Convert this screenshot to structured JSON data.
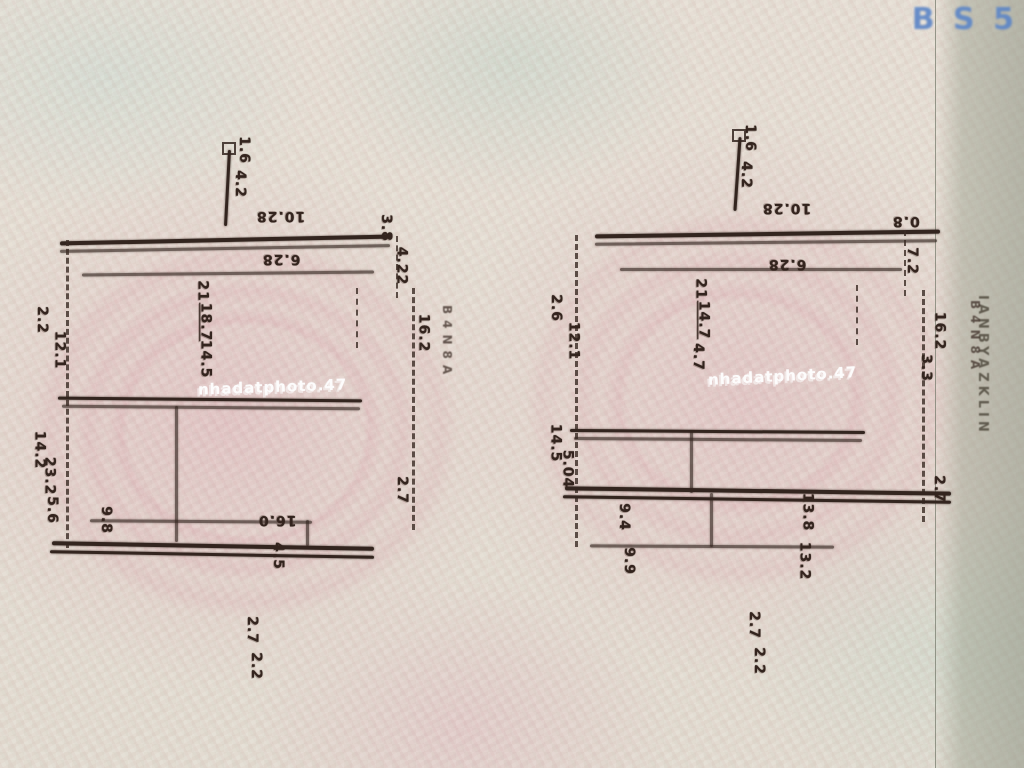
{
  "page": {
    "logo_text": "B S 5",
    "edge_text": "IANBYAZKLIN",
    "watermark_text": "nhadatphoto.47",
    "ink_color": "#33251f",
    "paper_pink": "#dfc3c6",
    "paper_green": "#d3dbcf",
    "logo_color": "#5b85c7"
  },
  "sketches": [
    {
      "name": "left-sketch",
      "watermark": "nhadatphoto.47",
      "side_marks": "B4N8A",
      "labels": [
        {
          "text": "1.6",
          "x": 210,
          "y": 22,
          "rot": 90
        },
        {
          "text": "4.2",
          "x": 206,
          "y": 56,
          "rot": 90
        },
        {
          "text": "10.28",
          "x": 236,
          "y": 88,
          "rot": 180
        },
        {
          "text": "3.8",
          "x": 352,
          "y": 100,
          "rot": 90
        },
        {
          "text": "6.28",
          "x": 242,
          "y": 131,
          "rot": 180
        },
        {
          "text": "4.22",
          "x": 362,
          "y": 138,
          "rot": 90
        },
        {
          "text": "21",
          "x": 172,
          "y": 163,
          "rot": 90
        },
        {
          "text": "18.7",
          "x": 166,
          "y": 194,
          "rot": 90,
          "underline": true
        },
        {
          "text": "14.5",
          "x": 166,
          "y": 231,
          "rot": 90
        },
        {
          "text": "2.2",
          "x": 8,
          "y": 192,
          "rot": 90
        },
        {
          "text": "12.1",
          "x": 20,
          "y": 222,
          "rot": 90
        },
        {
          "text": "16.2",
          "x": 384,
          "y": 205,
          "rot": 90
        },
        {
          "text": "14.2",
          "x": 0,
          "y": 322,
          "rot": 90
        },
        {
          "text": "23.2",
          "x": 10,
          "y": 348,
          "rot": 90
        },
        {
          "text": "5.6",
          "x": 18,
          "y": 382,
          "rot": 90
        },
        {
          "text": "2.7",
          "x": 368,
          "y": 362,
          "rot": 90
        },
        {
          "text": "9.8",
          "x": 72,
          "y": 392,
          "rot": 90
        },
        {
          "text": "16.0",
          "x": 238,
          "y": 392,
          "rot": 180
        },
        {
          "text": "4.5",
          "x": 244,
          "y": 428,
          "rot": 90
        },
        {
          "text": "2.7",
          "x": 218,
          "y": 502,
          "rot": 90
        },
        {
          "text": "2.2",
          "x": 222,
          "y": 538,
          "rot": 90
        }
      ]
    },
    {
      "name": "right-sketch",
      "watermark": "nhadatphoto.47",
      "side_marks": "B4N8A",
      "labels": [
        {
          "text": "1.6",
          "x": 196,
          "y": 25,
          "rot": 90
        },
        {
          "text": "4.2",
          "x": 192,
          "y": 62,
          "rot": 90
        },
        {
          "text": "10.28",
          "x": 222,
          "y": 95,
          "rot": 180
        },
        {
          "text": "0.8",
          "x": 352,
          "y": 108,
          "rot": 180
        },
        {
          "text": "6.28",
          "x": 228,
          "y": 151,
          "rot": 180
        },
        {
          "text": "7.2",
          "x": 358,
          "y": 148,
          "rot": 90
        },
        {
          "text": "21",
          "x": 150,
          "y": 176,
          "rot": 90
        },
        {
          "text": "14.7",
          "x": 144,
          "y": 207,
          "rot": 90,
          "underline": true
        },
        {
          "text": "4.7",
          "x": 144,
          "y": 244,
          "rot": 90
        },
        {
          "text": "2.6",
          "x": 2,
          "y": 195,
          "rot": 90
        },
        {
          "text": "12.1",
          "x": 14,
          "y": 228,
          "rot": 90
        },
        {
          "text": "16.2",
          "x": 380,
          "y": 218,
          "rot": 90
        },
        {
          "text": "3.3",
          "x": 372,
          "y": 255,
          "rot": 90
        },
        {
          "text": "14.5",
          "x": -4,
          "y": 330,
          "rot": 90
        },
        {
          "text": "5.04",
          "x": 8,
          "y": 356,
          "rot": 90
        },
        {
          "text": "2.7",
          "x": 385,
          "y": 376,
          "rot": 90
        },
        {
          "text": "9.4",
          "x": 70,
          "y": 404,
          "rot": 90
        },
        {
          "text": "13.8",
          "x": 248,
          "y": 399,
          "rot": 90
        },
        {
          "text": "9.9",
          "x": 75,
          "y": 448,
          "rot": 90
        },
        {
          "text": "13.2",
          "x": 245,
          "y": 448,
          "rot": 90
        },
        {
          "text": "2.7",
          "x": 200,
          "y": 512,
          "rot": 90
        },
        {
          "text": "2.2",
          "x": 205,
          "y": 548,
          "rot": 90
        }
      ]
    }
  ]
}
